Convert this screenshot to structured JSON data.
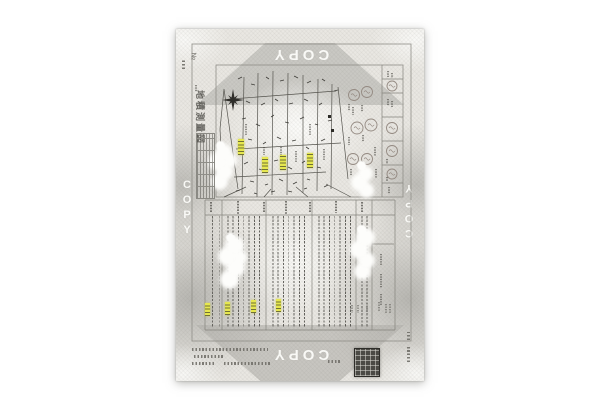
{
  "document": {
    "watermark": {
      "text": "COPY",
      "color": "#fcfcf9",
      "positions": [
        "top-center-rotated-180",
        "left-edge-vertical",
        "right-edge-vertical-rotated-180",
        "bottom-center-rotated-180"
      ]
    },
    "title_block": {
      "title": "地積測量図"
    },
    "corner_mark": "№",
    "colors": {
      "paper": "#e9e7e2",
      "shading": "#b6b5b0",
      "highlight": "#e6e74f",
      "stamp": "#4b4a45",
      "linework": "#55544e"
    },
    "icons": {
      "compass": "compass-rose",
      "round_seal": "round-seal",
      "registry_stamp": "square-registry-stamp",
      "benchmark": "benchmark-square"
    },
    "map": {
      "highlight_count": 4,
      "seal_count": 10
    },
    "table": {
      "highlight_count": 4
    }
  }
}
